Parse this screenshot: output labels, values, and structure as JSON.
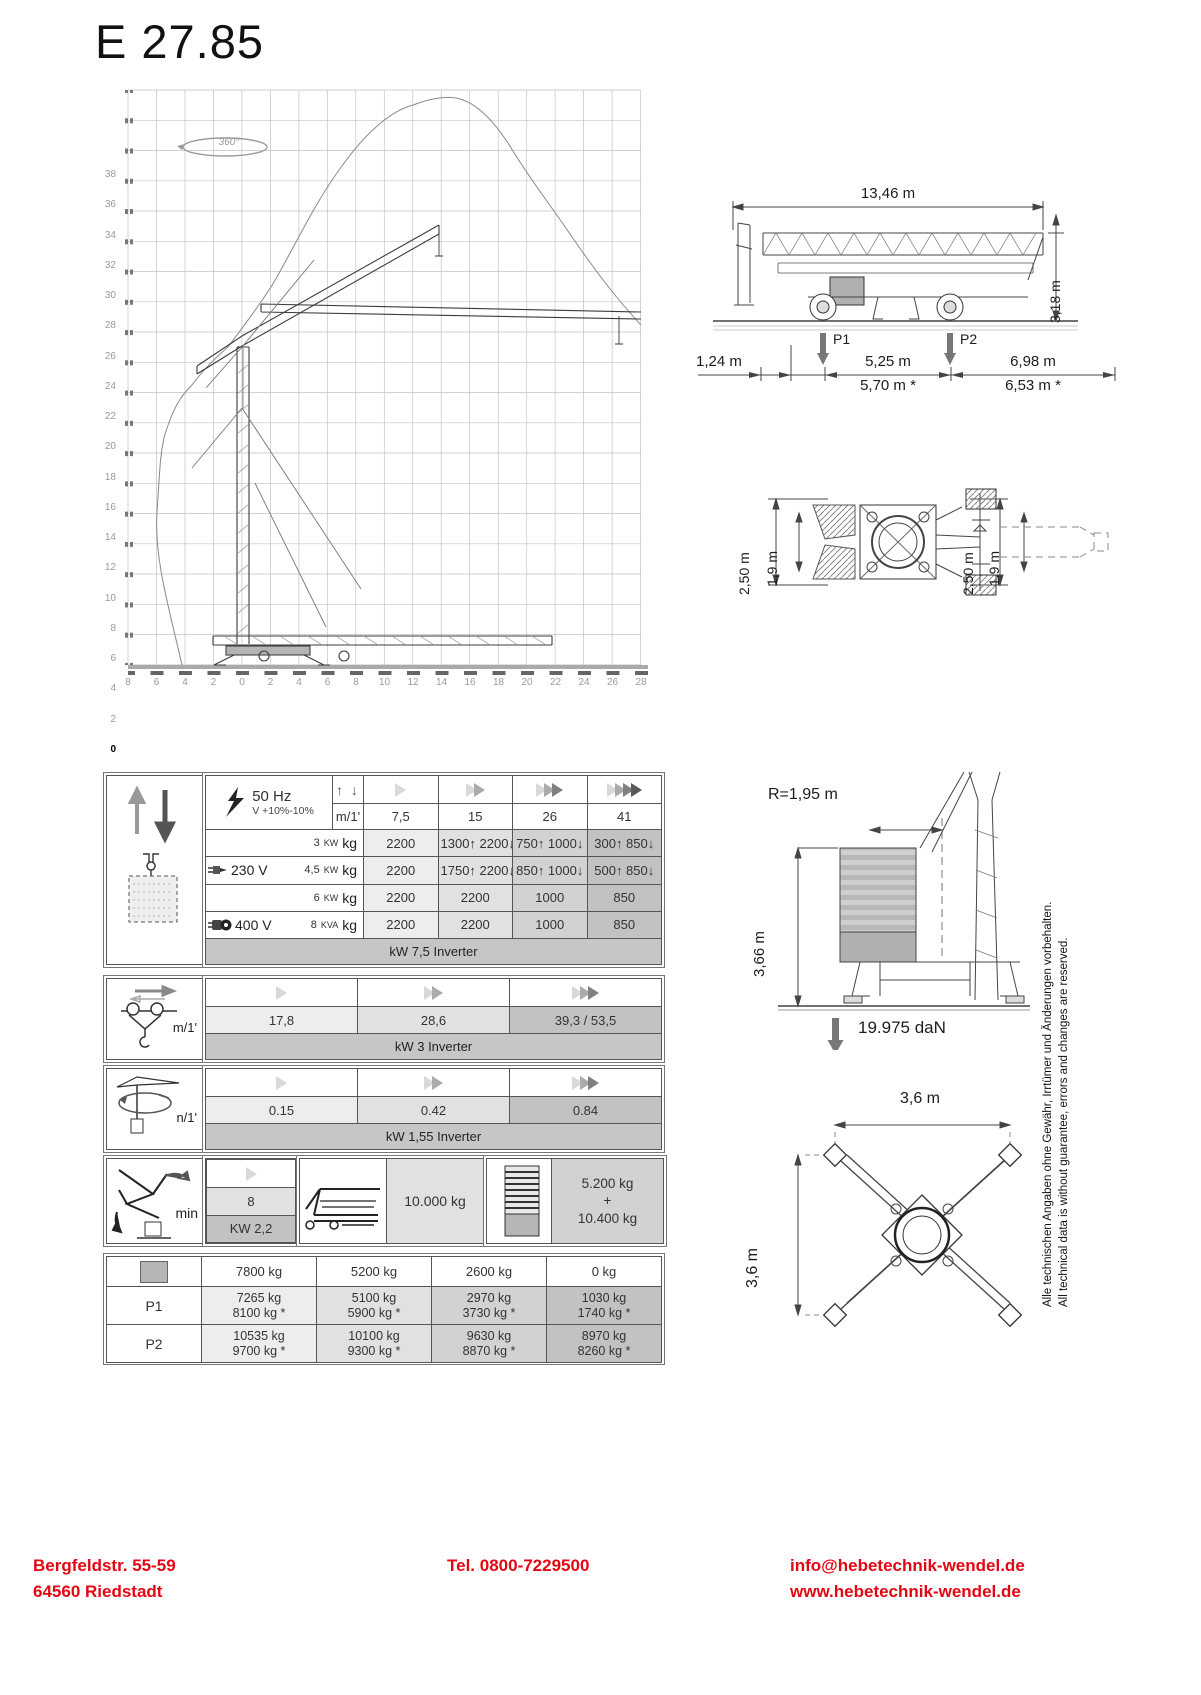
{
  "title": "E 27.85",
  "colors": {
    "accent_red": "#e30613",
    "column_shades": [
      "#ededed",
      "#e1e1e1",
      "#d2d2d2",
      "#c2c2c2"
    ],
    "band_gray": "#c6c6c6"
  },
  "diagram": {
    "rotation": "360°",
    "y_ticks": [
      "38",
      "36",
      "34",
      "32",
      "30",
      "28",
      "26",
      "24",
      "22",
      "20",
      "18",
      "16",
      "14",
      "12",
      "10",
      "8",
      "6",
      "4",
      "2",
      "0"
    ],
    "x_ticks": [
      "8",
      "6",
      "4",
      "2",
      "0",
      "2",
      "4",
      "6",
      "8",
      "10",
      "12",
      "14",
      "16",
      "18",
      "20",
      "22",
      "24",
      "26",
      "28"
    ]
  },
  "side_view": {
    "length": "13,46 m",
    "height": "3,18 m",
    "p1": "P1",
    "p2": "P2",
    "d1": "1,24 m",
    "d2": "5,25 m",
    "d3": "6,98 m",
    "d2b": "5,70 m *",
    "d3b": "6,53 m *"
  },
  "top_view": {
    "outer_l": "2,50 m",
    "inner_l": "1,9 m",
    "outer_r": "2,50 m",
    "inner_r": "1,9 m"
  },
  "hoist": {
    "freq": "50 Hz",
    "tol": "V +10%-10%",
    "updown_icon": "↑ ↓",
    "unit": "m/1'",
    "speeds": [
      "7,5",
      "15",
      "26",
      "41"
    ],
    "rows": [
      {
        "voltage": "",
        "power": "3",
        "power_unit": "KW",
        "unit": "kg",
        "cells": [
          "2200",
          "1300↑ 2200↓",
          "750↑ 1000↓",
          "300↑ 850↓"
        ]
      },
      {
        "voltage": "230 V",
        "power": "4,5",
        "power_unit": "KW",
        "unit": "kg",
        "cells": [
          "2200",
          "1750↑ 2200↓",
          "850↑ 1000↓",
          "500↑ 850↓"
        ]
      },
      {
        "voltage": "",
        "power": "6",
        "power_unit": "KW",
        "unit": "kg",
        "cells": [
          "2200",
          "2200",
          "1000",
          "850"
        ]
      },
      {
        "voltage": "400 V",
        "power": "8",
        "power_unit": "KVA",
        "unit": "kg",
        "cells": [
          "2200",
          "2200",
          "1000",
          "850"
        ]
      }
    ],
    "note": "kW 7,5  Inverter"
  },
  "trolley": {
    "unit": "m/1'",
    "values": [
      "17,8",
      "28,6",
      "39,3 / 53,5"
    ],
    "note": "kW 3  Inverter"
  },
  "slewing": {
    "unit": "n/1'",
    "values": [
      "0.15",
      "0.42",
      "0.84"
    ],
    "note": "kW  1,55 Inverter"
  },
  "erection": {
    "label": "min",
    "time": "8",
    "power": "KW 2,2",
    "transport": "10.000 kg",
    "ballast_top": "5.200 kg",
    "ballast_plus": "+",
    "ballast_bottom": "10.400 kg"
  },
  "loads": {
    "headers": [
      "7800 kg",
      "5200 kg",
      "2600 kg",
      "0 kg"
    ],
    "rows": [
      {
        "label": "P1",
        "cells": [
          [
            "7265 kg",
            "8100 kg *"
          ],
          [
            "5100 kg",
            "5900 kg *"
          ],
          [
            "2970 kg",
            "3730 kg *"
          ],
          [
            "1030 kg",
            "1740 kg *"
          ]
        ]
      },
      {
        "label": "P2",
        "cells": [
          [
            "10535 kg",
            "9700 kg *"
          ],
          [
            "10100 kg",
            "9300 kg *"
          ],
          [
            "9630 kg",
            "8870 kg *"
          ],
          [
            "8970 kg",
            "8260 kg *"
          ]
        ]
      }
    ]
  },
  "erected": {
    "radius": "R=1,95 m",
    "height": "3,66 m",
    "force": "19.975 daN"
  },
  "base": {
    "width": "3,6 m",
    "depth": "3,6  m"
  },
  "disclaimer": {
    "de": "Alle technischen Angaben ohne Gewähr, Irrtümer und Änderungen vorbehalten.",
    "en": "All technical data is without guarantee, errors and changes are reserved."
  },
  "footer": {
    "address1": "Bergfeldstr. 55-59",
    "address2": "64560 Riedstadt",
    "phone": "Tel.  0800-7229500",
    "email": "info@hebetechnik-wendel.de",
    "web": "www.hebetechnik-wendel.de"
  }
}
